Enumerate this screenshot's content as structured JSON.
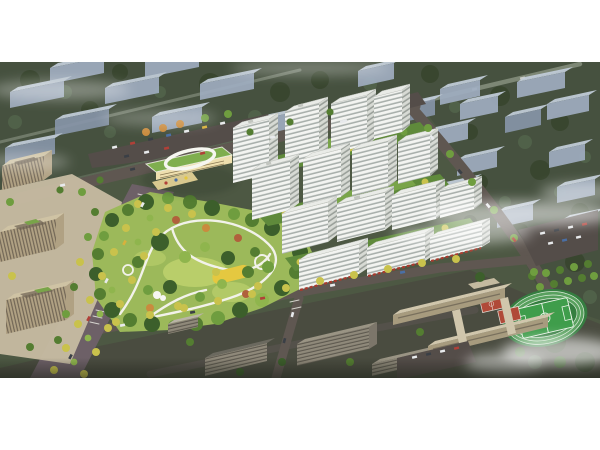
{
  "scene": {
    "label": "aerial-architectural-rendering",
    "regions": [
      {
        "name": "ghost-city-blocks",
        "desc": "faded blue-gray context buildings"
      },
      {
        "name": "residential-tower-cluster",
        "desc": "white high-rise apartment towers"
      },
      {
        "name": "central-park",
        "desc": "landscaped park with winding paths"
      },
      {
        "name": "kindergarten-building",
        "desc": "green-roof school with white loop"
      },
      {
        "name": "office-complex",
        "desc": "beige office blocks with roof terraces"
      },
      {
        "name": "tree-lined-boulevard",
        "desc": "avenue with yellow trees"
      },
      {
        "name": "commercial-frontage",
        "desc": "shops with red awnings"
      },
      {
        "name": "school-campus",
        "desc": "low beige teaching blocks"
      },
      {
        "name": "sports-field",
        "desc": "running track, pitch and red courts"
      },
      {
        "name": "parking-lots",
        "desc": "dark asphalt with parked cars"
      },
      {
        "name": "mist-clouds",
        "desc": "white haze wisps"
      }
    ]
  },
  "colors": {
    "page-bg": "#ffffff",
    "ground-top": "#46513f",
    "ground-mid": "#4d5843",
    "city-ground": "#4a4c40",
    "ghost-roof": "#c3cedb",
    "ghost-face": "#9fadc0",
    "ghost-face-dark": "#8795a8",
    "ghost-road": "#87917f",
    "ghost-tree-dark": "#39462f",
    "ghost-tree-mid": "#51624a",
    "road-main": "#5f5751",
    "road-boulevard": "#6d6067",
    "plaza-tan": "#c7bca2",
    "parking-dark": "#544d49",
    "office-roof": "#cfc3a4",
    "office-face": "#b0a183",
    "office-window": "#6e6353",
    "kinder-roof": "#7fae4e",
    "kinder-face": "#eedfae",
    "path-white": "#f2f2ea",
    "park-lawn": "#9cb95a",
    "lawn-light": "#bcd06c",
    "tree-dark": "#3c5f2b",
    "tree-mid": "#547d31",
    "tree-green": "#6f9d3f",
    "tree-light": "#8fb54d",
    "tree-yellow": "#c9c24c",
    "tree-orange": "#c98b3e",
    "tree-red": "#b0613c",
    "play-yellow": "#e5c840",
    "pond-blue": "#7fb3c0",
    "tower-front": "#f3f4f1",
    "tower-stripe": "#a9b0ac",
    "tower-side": "#d7dad4",
    "tower-side-stripe": "#9aa09a",
    "tower-roof": "#e9ebe7",
    "roof-edge": "#c2c5bf",
    "courtyard-green": "#5f8a3b",
    "podium-roof": "#79a449",
    "shop-red": "#a83a2e",
    "city-roof-tan": "#9a9484",
    "city-roof-dark": "#6b695f",
    "city-face": "#8f897a",
    "school-roof": "#d0c6ac",
    "school-face": "#a79b7e",
    "field-apron": "#357e40",
    "field-track": "#58a05e",
    "field-pitch": "#3f9d4b",
    "field-line": "#e9f3e6",
    "court-red": "#b04a38",
    "car-white": "#e8eaec",
    "car-dark": "#3a3f46",
    "car-red": "#b04038",
    "car-blue": "#4a6fa5",
    "car-yellow": "#d8b13c",
    "mist-white": "#ffffff"
  }
}
